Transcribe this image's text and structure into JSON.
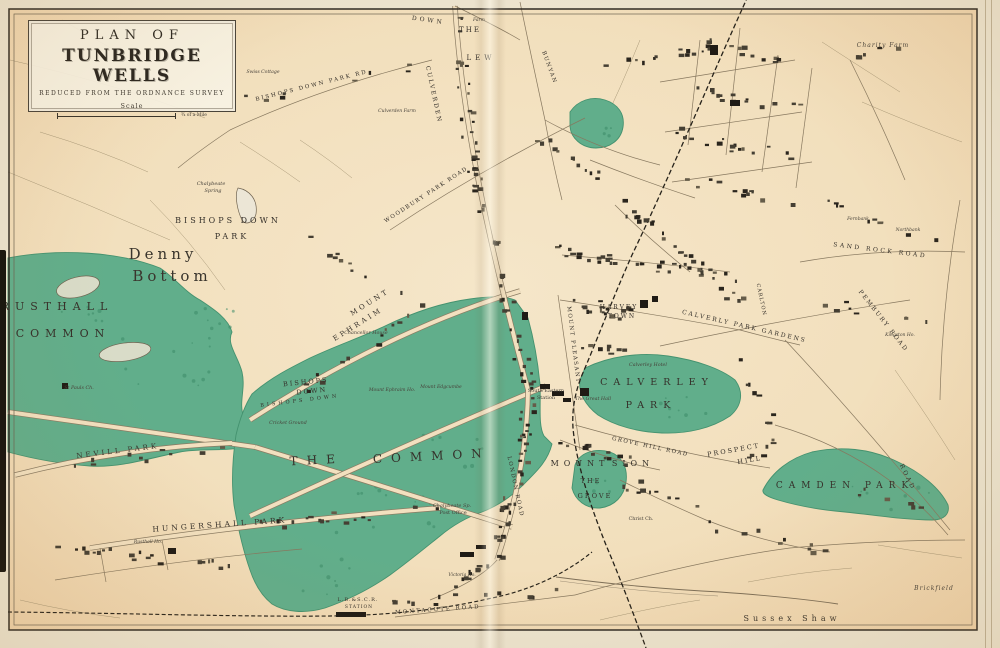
{
  "title": {
    "line1": "PLAN OF",
    "line2": "TUNBRIDGE WELLS",
    "subtitle": "REDUCED FROM THE ORDNANCE SURVEY",
    "scale_label": "Scale",
    "scale_note": "¾ of a Mile"
  },
  "colors": {
    "paper": "#f3e1c0",
    "paper_edge": "#eed3ac",
    "green": "#61ae8b",
    "green_edge": "#44926f",
    "ink": "#39342b",
    "building": "#453f33",
    "railway": "#26221a"
  },
  "map_labels": [
    {
      "t": "RUSTHALL",
      "x": 57,
      "y": 310,
      "s": 11,
      "ls": 6,
      "r": 0,
      "c": "caps"
    },
    {
      "t": "COMMON",
      "x": 63,
      "y": 337,
      "s": 11,
      "ls": 6,
      "r": 0,
      "c": "caps"
    },
    {
      "t": "Denny",
      "x": 163,
      "y": 259,
      "s": 15,
      "ls": 4,
      "r": 0,
      "c": "serif"
    },
    {
      "t": "Bottom",
      "x": 172,
      "y": 281,
      "s": 15,
      "ls": 4,
      "r": 0,
      "c": "serif"
    },
    {
      "t": "BISHOPS DOWN",
      "x": 228,
      "y": 223,
      "s": 8,
      "ls": 3,
      "r": 0,
      "c": "caps"
    },
    {
      "t": "PARK",
      "x": 232,
      "y": 239,
      "s": 8,
      "ls": 3,
      "r": 0,
      "c": "caps"
    },
    {
      "t": "THE",
      "x": 317,
      "y": 464,
      "s": 12,
      "ls": 9,
      "r": -3,
      "c": "caps"
    },
    {
      "t": "COMMON",
      "x": 432,
      "y": 460,
      "s": 12,
      "ls": 9,
      "r": -3,
      "c": "caps"
    },
    {
      "t": "CALVERLEY",
      "x": 657,
      "y": 385,
      "s": 9.5,
      "ls": 6,
      "r": 0,
      "c": "caps"
    },
    {
      "t": "PARK",
      "x": 651,
      "y": 408,
      "s": 9.5,
      "ls": 6,
      "r": 0,
      "c": "caps"
    },
    {
      "t": "CAMDEN PARK",
      "x": 845,
      "y": 488,
      "s": 9,
      "ls": 6,
      "r": 0,
      "c": "caps"
    },
    {
      "t": "MOUNT",
      "x": 580,
      "y": 466,
      "s": 8,
      "ls": 5,
      "r": 0,
      "c": "caps"
    },
    {
      "t": "SION",
      "x": 633,
      "y": 466,
      "s": 8,
      "ls": 5,
      "r": 0,
      "c": "caps"
    },
    {
      "t": "THE",
      "x": 591,
      "y": 483,
      "s": 6.5,
      "ls": 2,
      "r": 0,
      "c": "caps"
    },
    {
      "t": "GROVE",
      "x": 595,
      "y": 498,
      "s": 6.5,
      "ls": 2,
      "r": 0,
      "c": "caps"
    },
    {
      "t": "HUNGERSHALL PARK",
      "x": 220,
      "y": 527,
      "s": 7.5,
      "ls": 3,
      "r": -4,
      "c": "caps"
    },
    {
      "t": "NEVILL PARK",
      "x": 118,
      "y": 453,
      "s": 7,
      "ls": 3,
      "r": -7,
      "c": "caps"
    },
    {
      "t": "HARVEY",
      "x": 619,
      "y": 309,
      "s": 6,
      "ls": 2,
      "r": 0,
      "c": "caps"
    },
    {
      "t": "TOWN",
      "x": 622,
      "y": 318,
      "s": 6,
      "ls": 2,
      "r": 0,
      "c": "caps"
    },
    {
      "t": "PROSPECT",
      "x": 734,
      "y": 452,
      "s": 6.5,
      "ls": 2,
      "r": -10,
      "c": "caps"
    },
    {
      "t": "HILL",
      "x": 750,
      "y": 462,
      "s": 6.5,
      "ls": 2,
      "r": -10,
      "c": "caps"
    },
    {
      "t": "Sussex Shaw",
      "x": 792,
      "y": 621,
      "s": 8,
      "ls": 4,
      "r": 0,
      "c": "serif"
    },
    {
      "t": "Brickfield",
      "x": 934,
      "y": 590,
      "s": 6,
      "ls": 1,
      "r": 0,
      "c": "ital"
    },
    {
      "t": "Charity Farm",
      "x": 883,
      "y": 47,
      "s": 6,
      "ls": 1,
      "r": 0,
      "c": "ital"
    },
    {
      "t": "BISHOPS DOWN PARK RD",
      "x": 312,
      "y": 87,
      "s": 5.5,
      "ls": 2,
      "r": -14,
      "c": "caps"
    },
    {
      "t": "MOUNT",
      "x": 371,
      "y": 304,
      "s": 7,
      "ls": 3,
      "r": -32,
      "c": "caps"
    },
    {
      "t": "EPHRAIM",
      "x": 359,
      "y": 326,
      "s": 7,
      "ls": 3,
      "r": -32,
      "c": "caps"
    },
    {
      "t": "BISHOPS",
      "x": 306,
      "y": 384,
      "s": 6.5,
      "ls": 2,
      "r": -6,
      "c": "caps"
    },
    {
      "t": "DOWN",
      "x": 312,
      "y": 393,
      "s": 6.5,
      "ls": 2,
      "r": -6,
      "c": "caps"
    },
    {
      "t": "BISHOPS DOWN",
      "x": 300,
      "y": 402,
      "s": 5,
      "ls": 3,
      "r": -7,
      "c": "caps"
    },
    {
      "t": "WOODBURY PARK ROAD",
      "x": 427,
      "y": 196,
      "s": 5.5,
      "ls": 1.5,
      "r": -33,
      "c": "caps"
    },
    {
      "t": "BUNYAN",
      "x": 548,
      "y": 68,
      "s": 5.5,
      "ls": 1.5,
      "r": 70,
      "c": "caps"
    },
    {
      "t": "CULVERDEN",
      "x": 432,
      "y": 95,
      "s": 6,
      "ls": 2,
      "r": 78,
      "c": "caps"
    },
    {
      "t": "MONTACUTE ROAD",
      "x": 438,
      "y": 611,
      "s": 5.5,
      "ls": 2,
      "r": -4,
      "c": "caps"
    },
    {
      "t": "L.B.&S.C.R.",
      "x": 358,
      "y": 601,
      "s": 5,
      "ls": 1,
      "r": 0,
      "c": "caps"
    },
    {
      "t": "STATION",
      "x": 359,
      "y": 608,
      "s": 4.5,
      "ls": 1,
      "r": 0,
      "c": "caps"
    },
    {
      "t": "GROVE HILL ROAD",
      "x": 650,
      "y": 448,
      "s": 5.5,
      "ls": 1.5,
      "r": 12,
      "c": "caps"
    },
    {
      "t": "CALVERLY PARK GARDENS",
      "x": 744,
      "y": 328,
      "s": 6,
      "ls": 2,
      "r": 13,
      "c": "caps"
    },
    {
      "t": "SAND ROCK ROAD",
      "x": 880,
      "y": 252,
      "s": 6,
      "ls": 2.5,
      "r": 7,
      "c": "caps"
    },
    {
      "t": "PEMBURY ROAD",
      "x": 882,
      "y": 322,
      "s": 6,
      "ls": 2,
      "r": 52,
      "c": "caps"
    },
    {
      "t": "ROAD",
      "x": 906,
      "y": 478,
      "s": 6,
      "ls": 2.5,
      "r": 64,
      "c": "caps"
    },
    {
      "t": "MOUNT PLEASANT",
      "x": 572,
      "y": 345,
      "s": 5.5,
      "ls": 1.5,
      "r": 83,
      "c": "caps"
    },
    {
      "t": "CARLTON",
      "x": 760,
      "y": 300,
      "s": 5,
      "ls": 1,
      "r": 78,
      "c": "caps"
    },
    {
      "t": "LONDON ROAD",
      "x": 514,
      "y": 487,
      "s": 5.5,
      "ls": 1.5,
      "r": 78,
      "c": "caps"
    },
    {
      "t": "DOWN",
      "x": 428,
      "y": 22,
      "s": 6,
      "ls": 3,
      "r": 8,
      "c": "caps"
    },
    {
      "t": "THE",
      "x": 470,
      "y": 32,
      "s": 7,
      "ls": 2,
      "r": 0,
      "c": "caps"
    },
    {
      "t": "LEW",
      "x": 481,
      "y": 60,
      "s": 7,
      "ls": 4,
      "r": 0,
      "c": "caps"
    },
    {
      "t": "Farm",
      "x": 479,
      "y": 21,
      "s": 4.5,
      "ls": 0,
      "r": 0,
      "c": "ital"
    },
    {
      "t": "Chalybeate",
      "x": 211,
      "y": 185,
      "s": 5,
      "ls": 0,
      "r": 0,
      "c": "ital"
    },
    {
      "t": "Spring",
      "x": 213,
      "y": 192,
      "s": 5,
      "ls": 0,
      "r": 0,
      "c": "ital"
    },
    {
      "t": "Chalybeate Sp.",
      "x": 452,
      "y": 507,
      "s": 5,
      "ls": 0,
      "r": 0,
      "c": "ital"
    },
    {
      "t": "Post Office",
      "x": 453,
      "y": 514,
      "s": 5,
      "ls": 0,
      "r": 0,
      "c": "small"
    },
    {
      "t": "South Eastern",
      "x": 546,
      "y": 392,
      "s": 5,
      "ls": 0,
      "r": 0,
      "c": "small"
    },
    {
      "t": "Station",
      "x": 546,
      "y": 399,
      "s": 5,
      "ls": 0,
      "r": 0,
      "c": "small"
    },
    {
      "t": "The Great Hall",
      "x": 593,
      "y": 400,
      "s": 4.8,
      "ls": 0,
      "r": 0,
      "c": "ital"
    },
    {
      "t": "Calverley Hotel",
      "x": 648,
      "y": 366,
      "s": 4.8,
      "ls": 0,
      "r": 0,
      "c": "ital"
    },
    {
      "t": "Chancellor House",
      "x": 366,
      "y": 334,
      "s": 4.8,
      "ls": 0,
      "r": 0,
      "c": "ital"
    },
    {
      "t": "Mount Ephraim Ho.",
      "x": 392,
      "y": 391,
      "s": 4.6,
      "ls": 0,
      "r": 0,
      "c": "ital"
    },
    {
      "t": "Mount Edgcumbe",
      "x": 441,
      "y": 388,
      "s": 4.6,
      "ls": 0,
      "r": 0,
      "c": "ital"
    },
    {
      "t": "Cricket Ground",
      "x": 288,
      "y": 424,
      "s": 4.8,
      "ls": 0,
      "r": 0,
      "c": "ital"
    },
    {
      "t": "St Pauls Ch.",
      "x": 79,
      "y": 389,
      "s": 4.8,
      "ls": 0,
      "r": 0,
      "c": "ital"
    },
    {
      "t": "Swiss Cottage",
      "x": 263,
      "y": 73,
      "s": 4.6,
      "ls": 0,
      "r": 0,
      "c": "ital"
    },
    {
      "t": "Culverden Farm",
      "x": 397,
      "y": 112,
      "s": 4.6,
      "ls": 0,
      "r": 0,
      "c": "ital"
    },
    {
      "t": "Christ Ch.",
      "x": 641,
      "y": 520,
      "s": 4.8,
      "ls": 0,
      "r": 0,
      "c": "small"
    },
    {
      "t": "Victoria Ho.",
      "x": 462,
      "y": 576,
      "s": 4.5,
      "ls": 0,
      "r": 0,
      "c": "ital"
    },
    {
      "t": "Fernbank",
      "x": 858,
      "y": 220,
      "s": 4.5,
      "ls": 0,
      "r": 0,
      "c": "ital"
    },
    {
      "t": "Northbank",
      "x": 908,
      "y": 231,
      "s": 4.5,
      "ls": 0,
      "r": 0,
      "c": "ital"
    },
    {
      "t": "Kingston Ho.",
      "x": 900,
      "y": 336,
      "s": 4.5,
      "ls": 0,
      "r": 0,
      "c": "ital"
    },
    {
      "t": "Rusthall Ho.",
      "x": 148,
      "y": 543,
      "s": 4.5,
      "ls": 0,
      "r": 0,
      "c": "ital"
    }
  ]
}
